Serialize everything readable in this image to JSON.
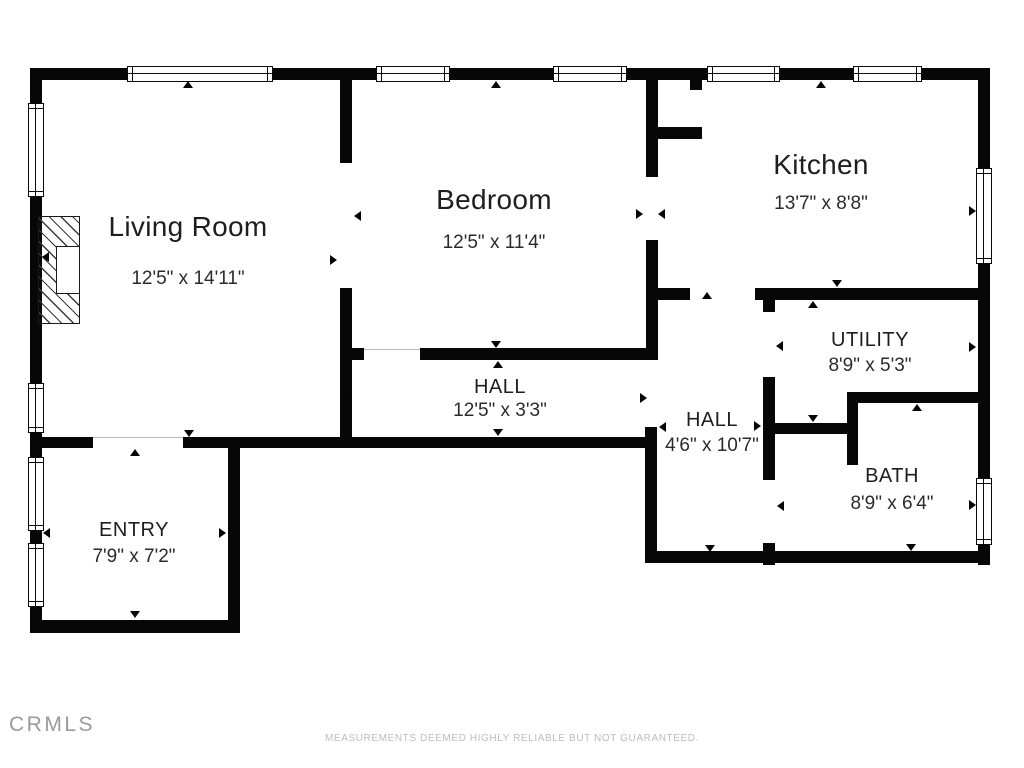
{
  "branding": {
    "logo": "CRMLS",
    "disclaimer": "MEASUREMENTS DEEMED HIGHLY RELIABLE BUT NOT GUARANTEED."
  },
  "colors": {
    "wall": "#070707",
    "background": "#ffffff",
    "label": "#1e1e1e",
    "muted": "#bcbcbc"
  },
  "rooms": [
    {
      "name": "Living Room",
      "dims": "12'5\" x 14'11\"",
      "size": "lg",
      "cx": 188,
      "name_y": 211,
      "dims_y": 268
    },
    {
      "name": "Bedroom",
      "dims": "12'5\" x 11'4\"",
      "size": "lg",
      "cx": 494,
      "name_y": 184,
      "dims_y": 232
    },
    {
      "name": "Kitchen",
      "dims": "13'7\" x 8'8\"",
      "size": "lg",
      "cx": 821,
      "name_y": 149,
      "dims_y": 193
    },
    {
      "name": "UTILITY",
      "dims": "8'9\" x 5'3\"",
      "size": "sm",
      "cx": 870,
      "name_y": 329,
      "dims_y": 355
    },
    {
      "name": "HALL",
      "dims": "12'5\" x 3'3\"",
      "size": "sm",
      "cx": 500,
      "name_y": 376,
      "dims_y": 400
    },
    {
      "name": "HALL",
      "dims": "4'6\" x 10'7\"",
      "size": "sm",
      "cx": 712,
      "name_y": 409,
      "dims_y": 435
    },
    {
      "name": "BATH",
      "dims": "8'9\" x 6'4\"",
      "size": "sm",
      "cx": 892,
      "name_y": 465,
      "dims_y": 493
    },
    {
      "name": "ENTRY",
      "dims": "7'9\" x 7'2\"",
      "size": "sm",
      "cx": 134,
      "name_y": 519,
      "dims_y": 546
    }
  ],
  "walls": [
    [
      30,
      68,
      960,
      12
    ],
    [
      30,
      68,
      12,
      565
    ],
    [
      978,
      68,
      12,
      497
    ],
    [
      645,
      551,
      345,
      12
    ],
    [
      30,
      437,
      63,
      11
    ],
    [
      183,
      437,
      474,
      11
    ],
    [
      228,
      437,
      12,
      196
    ],
    [
      30,
      620,
      210,
      13
    ],
    [
      340,
      68,
      12,
      95
    ],
    [
      340,
      288,
      12,
      160
    ],
    [
      340,
      348,
      24,
      12
    ],
    [
      420,
      348,
      229,
      12
    ],
    [
      646,
      68,
      12,
      109
    ],
    [
      690,
      80,
      12,
      10
    ],
    [
      656,
      127,
      46,
      12
    ],
    [
      646,
      240,
      12,
      120
    ],
    [
      645,
      427,
      12,
      126
    ],
    [
      646,
      288,
      44,
      12
    ],
    [
      755,
      288,
      225,
      12
    ],
    [
      763,
      300,
      12,
      12
    ],
    [
      763,
      377,
      12,
      103
    ],
    [
      763,
      543,
      12,
      22
    ],
    [
      847,
      392,
      136,
      11
    ],
    [
      847,
      392,
      11,
      73
    ],
    [
      763,
      423,
      90,
      11
    ]
  ],
  "windows": [
    {
      "x": 127,
      "y": 66,
      "w": 146,
      "h": 16,
      "o": "h"
    },
    {
      "x": 376,
      "y": 66,
      "w": 74,
      "h": 16,
      "o": "h"
    },
    {
      "x": 553,
      "y": 66,
      "w": 74,
      "h": 16,
      "o": "h"
    },
    {
      "x": 707,
      "y": 66,
      "w": 73,
      "h": 16,
      "o": "h"
    },
    {
      "x": 853,
      "y": 66,
      "w": 69,
      "h": 16,
      "o": "h"
    },
    {
      "x": 28,
      "y": 103,
      "w": 16,
      "h": 94,
      "o": "v"
    },
    {
      "x": 28,
      "y": 383,
      "w": 16,
      "h": 50,
      "o": "v"
    },
    {
      "x": 28,
      "y": 457,
      "w": 16,
      "h": 74,
      "o": "v"
    },
    {
      "x": 28,
      "y": 543,
      "w": 16,
      "h": 64,
      "o": "v"
    },
    {
      "x": 976,
      "y": 168,
      "w": 16,
      "h": 96,
      "o": "v"
    },
    {
      "x": 976,
      "y": 478,
      "w": 16,
      "h": 67,
      "o": "v"
    }
  ],
  "openings": [
    [
      93,
      437,
      90,
      1
    ],
    [
      364,
      349,
      56,
      1
    ]
  ],
  "markers": [
    {
      "x": 183,
      "y": 81,
      "dir": "up"
    },
    {
      "x": 42,
      "y": 252,
      "dir": "left"
    },
    {
      "x": 330,
      "y": 255,
      "dir": "right"
    },
    {
      "x": 184,
      "y": 430,
      "dir": "down"
    },
    {
      "x": 491,
      "y": 81,
      "dir": "up"
    },
    {
      "x": 354,
      "y": 211,
      "dir": "left"
    },
    {
      "x": 636,
      "y": 209,
      "dir": "right"
    },
    {
      "x": 491,
      "y": 341,
      "dir": "down"
    },
    {
      "x": 816,
      "y": 81,
      "dir": "up"
    },
    {
      "x": 658,
      "y": 209,
      "dir": "left"
    },
    {
      "x": 969,
      "y": 206,
      "dir": "right"
    },
    {
      "x": 832,
      "y": 280,
      "dir": "down"
    },
    {
      "x": 493,
      "y": 361,
      "dir": "up"
    },
    {
      "x": 344,
      "y": 394,
      "dir": "left"
    },
    {
      "x": 640,
      "y": 393,
      "dir": "right"
    },
    {
      "x": 493,
      "y": 429,
      "dir": "down"
    },
    {
      "x": 702,
      "y": 292,
      "dir": "up"
    },
    {
      "x": 659,
      "y": 422,
      "dir": "left"
    },
    {
      "x": 754,
      "y": 421,
      "dir": "right"
    },
    {
      "x": 705,
      "y": 545,
      "dir": "down"
    },
    {
      "x": 808,
      "y": 301,
      "dir": "up"
    },
    {
      "x": 776,
      "y": 341,
      "dir": "left"
    },
    {
      "x": 969,
      "y": 342,
      "dir": "right"
    },
    {
      "x": 808,
      "y": 415,
      "dir": "down"
    },
    {
      "x": 912,
      "y": 404,
      "dir": "up"
    },
    {
      "x": 777,
      "y": 501,
      "dir": "left"
    },
    {
      "x": 969,
      "y": 500,
      "dir": "right"
    },
    {
      "x": 906,
      "y": 544,
      "dir": "down"
    },
    {
      "x": 130,
      "y": 449,
      "dir": "up"
    },
    {
      "x": 43,
      "y": 528,
      "dir": "left"
    },
    {
      "x": 219,
      "y": 528,
      "dir": "right"
    },
    {
      "x": 130,
      "y": 611,
      "dir": "down"
    }
  ],
  "fireplace": {
    "x": 38,
    "y": 216,
    "w": 42,
    "h": 108,
    "inner": {
      "x": 56,
      "y": 246,
      "w": 24,
      "h": 48
    }
  }
}
